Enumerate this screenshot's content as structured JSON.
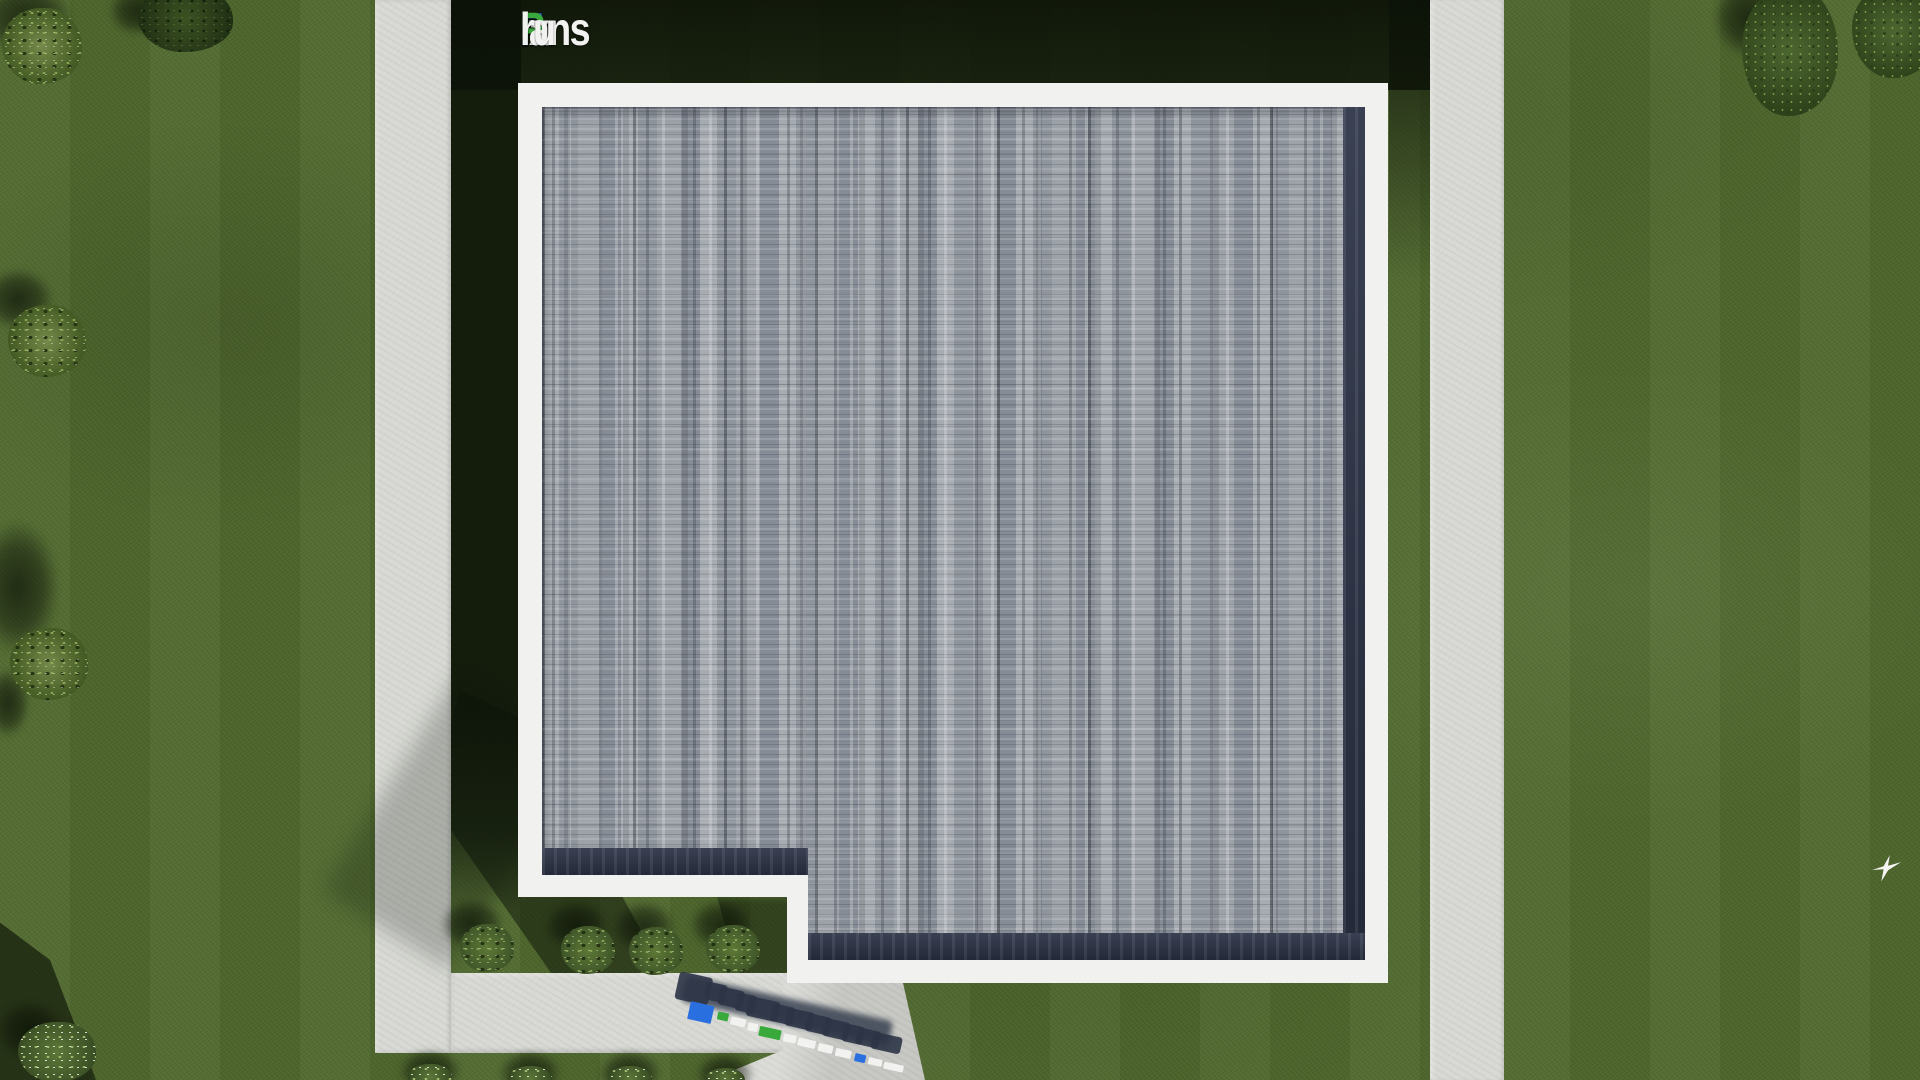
{
  "watermark": {
    "text": "FixPlans.ru",
    "parts": [
      {
        "text": "F",
        "color": "#2a6fe0"
      },
      {
        "text": "ix",
        "color": "#f2f3f1"
      },
      {
        "text": "P",
        "color": "#3aa93c"
      },
      {
        "text": "lans",
        "color": "#f2f3f1"
      },
      {
        "text": ".",
        "color": "#2a6fe0"
      },
      {
        "text": "ru",
        "color": "#f2f3f1"
      }
    ]
  },
  "ground_logo": {
    "text": "FixPlans.ru",
    "description": "extruded 3D brand letters standing on the entry walkway, casting shadows to the north-west",
    "slab_colors": [
      "blue",
      "green",
      "white",
      "white",
      "green",
      "white",
      "white",
      "white",
      "white",
      "blue",
      "white",
      "white"
    ]
  },
  "colors": {
    "logo-blue": "#2a6fe0",
    "logo-green": "#3aa93c",
    "logo-white": "#f2f3f1",
    "grass": "#50692e",
    "shadow-green": "#0b1107",
    "path": "#d8d9d4",
    "parapet": "#f1f2ef",
    "roof-gray": "#9aa0a7",
    "roof-navy": "#2b3245"
  },
  "scene": {
    "view": "top-down aerial render",
    "subject": "L-shaped flat-roof house with white parapet, shingle roof, lawn, concrete paths, shrubs and trees"
  }
}
